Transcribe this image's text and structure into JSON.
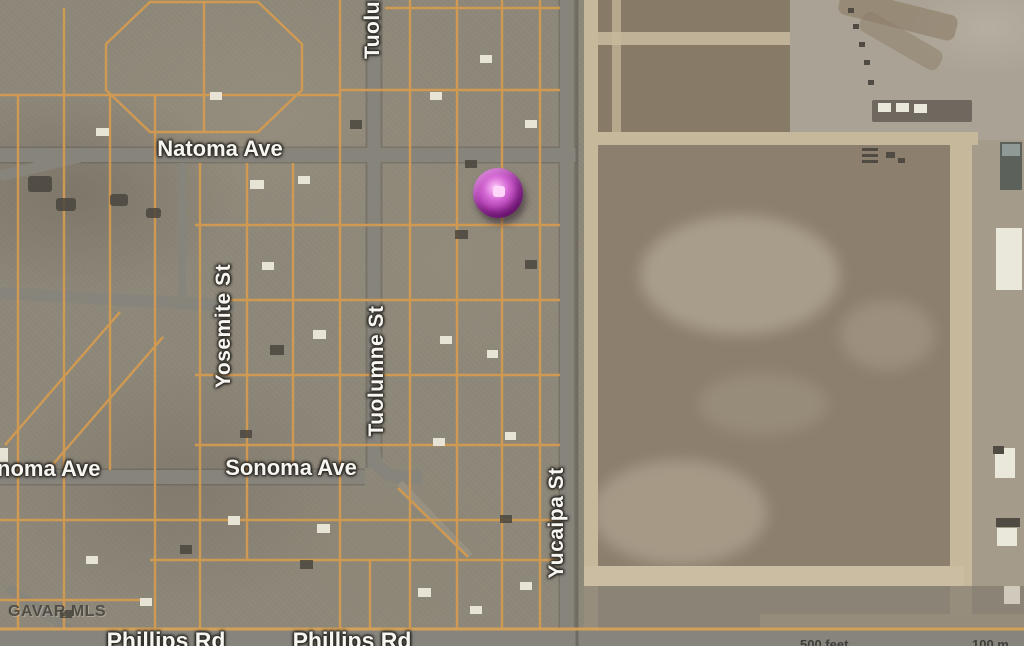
{
  "map": {
    "street_labels": [
      {
        "id": "tuolumne-st-partial-top",
        "text": "Tuolu",
        "orientation": "vertical"
      },
      {
        "id": "natoma-ave",
        "text": "Natoma Ave",
        "orientation": "horizontal"
      },
      {
        "id": "yosemite-st",
        "text": "Yosemite St",
        "orientation": "vertical"
      },
      {
        "id": "tuolumne-st",
        "text": "Tuolumne St",
        "orientation": "vertical"
      },
      {
        "id": "sonoma-ave-partial-left",
        "text": "noma Ave",
        "orientation": "horizontal"
      },
      {
        "id": "sonoma-ave",
        "text": "Sonoma Ave",
        "orientation": "horizontal"
      },
      {
        "id": "yucaipa-st",
        "text": "Yucaipa St",
        "orientation": "vertical"
      },
      {
        "id": "phillips-rd-west",
        "text": "Phillips Rd",
        "orientation": "horizontal"
      },
      {
        "id": "phillips-rd-east",
        "text": "Phillips Rd",
        "orientation": "horizontal"
      }
    ],
    "watermark": "GAVAR MLS",
    "scale_labels": {
      "imperial": "500 feet",
      "metric": "100 m"
    },
    "marker": {
      "name": "purple-pin",
      "color": "#b440b4",
      "x": 498,
      "y": 193
    },
    "colors": {
      "street_grid": "#d79a4e",
      "road_gray": "#85827a",
      "field_brown": "#8c7f6d",
      "label_text": "#f7f6f0"
    }
  }
}
